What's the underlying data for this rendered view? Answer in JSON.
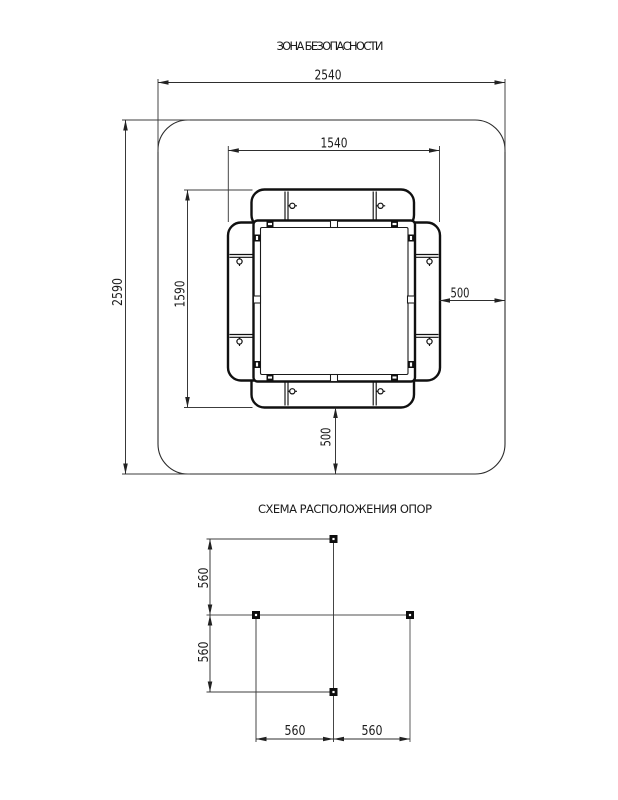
{
  "page": {
    "background": "#ffffff",
    "line_color": "#1a1a1a",
    "light_line_color": "#8a8a8a"
  },
  "safety_zone_figure": {
    "title": "ЗОНА БЕЗОПАСНОСТИ",
    "dim_outer_width": "2540",
    "dim_outer_height": "2590",
    "dim_inner_width": "1540",
    "dim_inner_height": "1590",
    "dim_side_clearance": "500",
    "dim_bottom_clearance": "500"
  },
  "supports_figure": {
    "title": "СХЕМА РАСПОЛОЖЕНИЯ ОПОР",
    "dim_vertical_upper": "560",
    "dim_vertical_lower": "560",
    "dim_horizontal_left": "560",
    "dim_horizontal_right": "560"
  }
}
